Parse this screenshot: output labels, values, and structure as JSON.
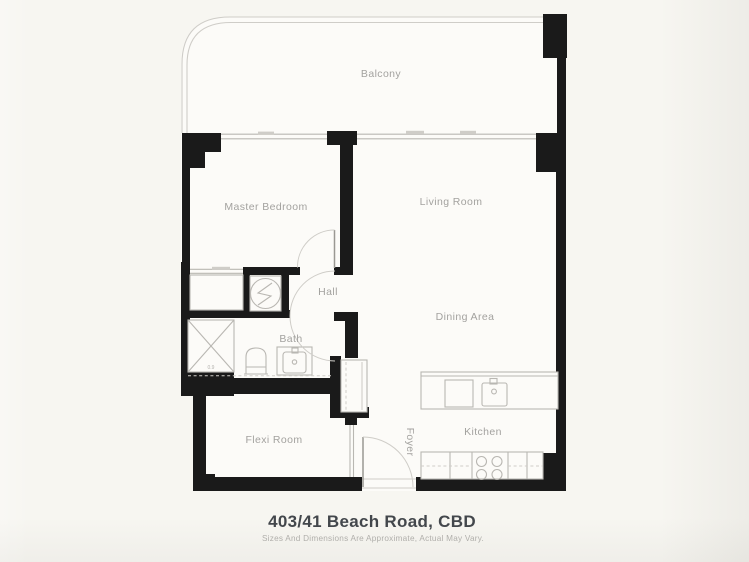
{
  "plan": {
    "title": "403/41 Beach Road, CBD",
    "disclaimer": "Sizes And Dimensions Are Approximate, Actual May Vary.",
    "rooms": {
      "balcony": "Balcony",
      "master_bedroom": "Master Bedroom",
      "living_room": "Living Room",
      "hall": "Hall",
      "bath": "Bath",
      "dining_area": "Dining Area",
      "flexi_room": "Flexi Room",
      "foyer": "Foyer",
      "kitchen": "Kitchen"
    },
    "annotations": {
      "shower_size": "0.9"
    },
    "fixtures": [
      "shower-fixture",
      "toilet-fixture",
      "vanity-basin-fixture",
      "washer-dryer-fixture",
      "wardrobe-fixture",
      "island-bench-fixture",
      "kitchen-sink-fixture",
      "dishwasher-fixture",
      "cooktop-4-burner-fixture",
      "entry-door-swing",
      "internal-door-swings",
      "balcony-railing",
      "window-glazing"
    ],
    "colors": {
      "wall": "#1a1a1a",
      "thin_line": "#b9b7b2",
      "light_line": "#cfcdc8",
      "floor": "#fcfbf8",
      "background": "#f7f6f1",
      "label_text": "#a3a29f",
      "title_text": "#43474c",
      "disclaimer_text": "#b2b1ad"
    }
  }
}
